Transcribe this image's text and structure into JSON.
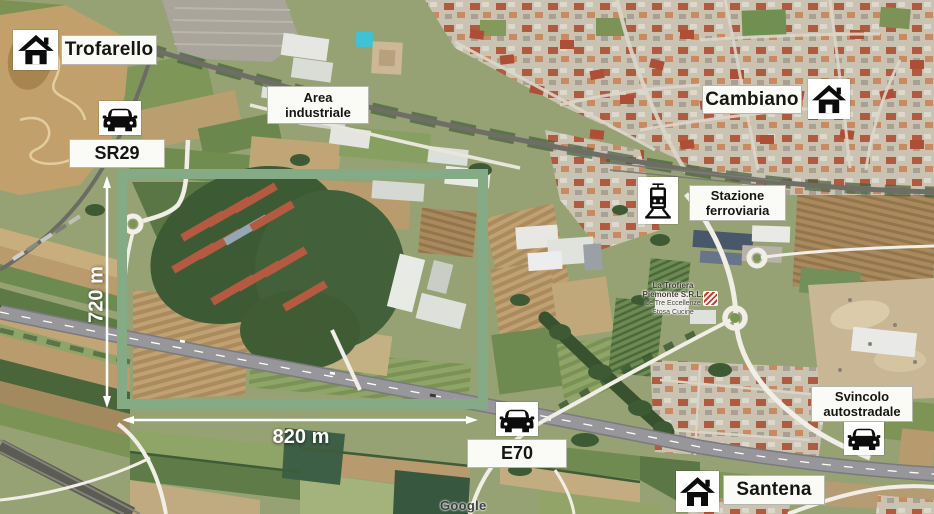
{
  "map": {
    "attribution": "Google",
    "business_label": {
      "line1": "La Trofiera",
      "line2": "Piemonte S.R.L.",
      "line3": "Le Tre Eccellenze",
      "line4": "Stosa Cucine"
    }
  },
  "annotations": {
    "trofarello": "Trofarello",
    "sr29": "SR29",
    "area_industriale": {
      "line1": "Area",
      "line2": "industriale"
    },
    "cambiano": "Cambiano",
    "stazione": {
      "line1": "Stazione",
      "line2": "ferroviaria"
    },
    "svincolo": {
      "line1": "Svincolo",
      "line2": "autostradale"
    },
    "e70": "E70",
    "santena": "Santena"
  },
  "measurements": {
    "height": "720 m",
    "width": "820 m"
  },
  "icons": {
    "trofarello": "home-icon",
    "cambiano": "home-icon",
    "santena": "home-icon",
    "sr29": "car-icon",
    "e70": "car-icon",
    "svincolo": "car-icon",
    "stazione": "train-icon"
  },
  "colors": {
    "site_outline": "#84aa86",
    "dimension_arrows": "#ffffff",
    "label_background": "#fafaf6",
    "label_text": "#151515"
  }
}
